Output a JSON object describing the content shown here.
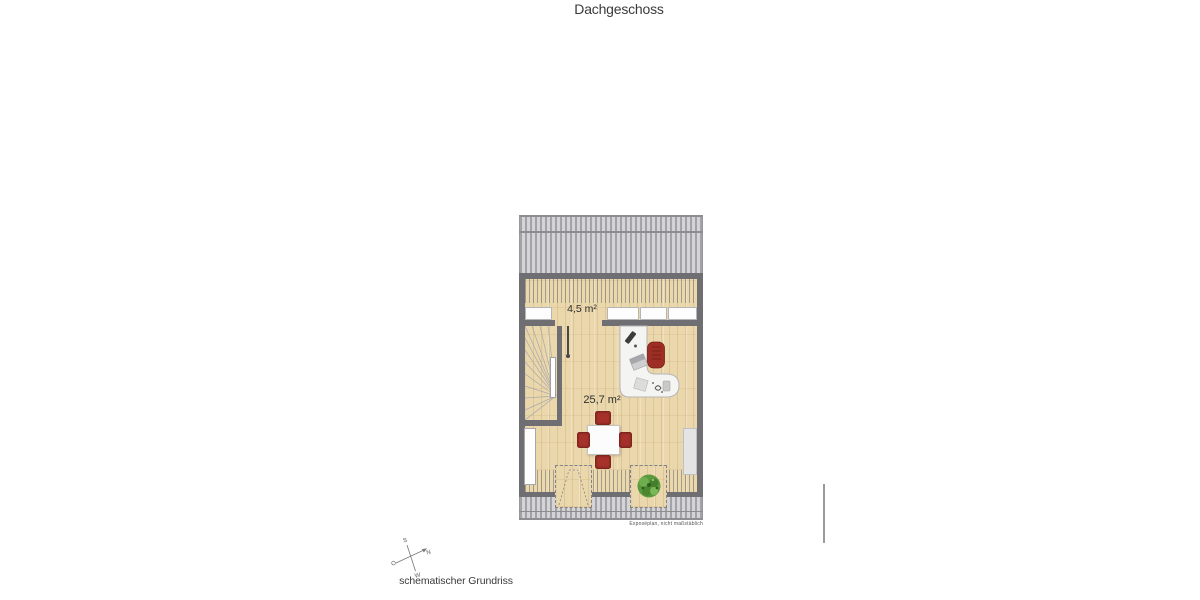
{
  "header": {
    "title": "Dachgeschoss"
  },
  "plan": {
    "area_labels": {
      "small": "4,5 m²",
      "large": "25,7 m²"
    },
    "disclaimer": "Exposéplan, nicht maßstäblich"
  },
  "compass": {
    "n": "N",
    "o": "O",
    "s": "S",
    "w": "W"
  },
  "footer": {
    "caption": "schematischer Grundriss"
  },
  "colors": {
    "wall": "#6e6e73",
    "roof_stripe_dark": "#a2a2a7",
    "roof_stripe_light": "#d4d4d7",
    "wood": "#ead7ac",
    "furniture_white": "#f4f4f2",
    "chair_red": "#a5312a",
    "plant_green": "#5b9a3c",
    "text": "#3a3a3a"
  }
}
